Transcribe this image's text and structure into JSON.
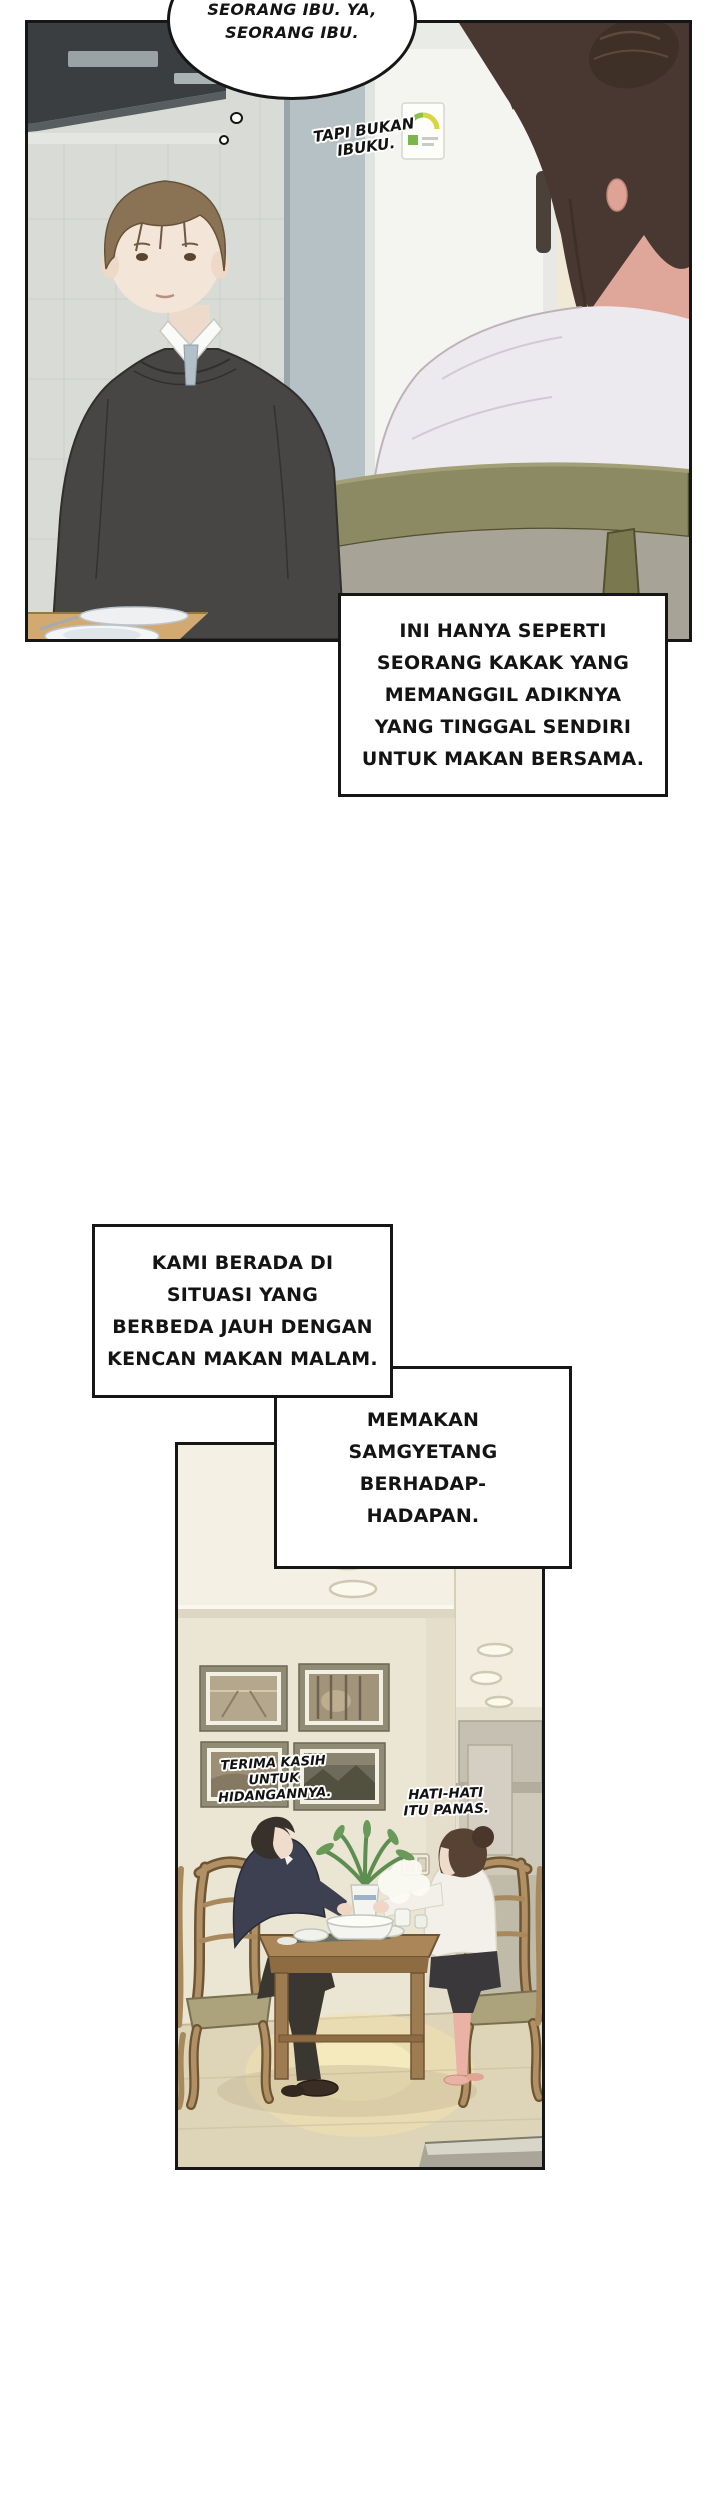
{
  "page": {
    "width": 720,
    "height": 2500,
    "background": "#ffffff"
  },
  "colors": {
    "panel_border": "#161616",
    "text": "#141414",
    "box_background": "#ffffff",
    "kitchen_wall_gray": "#d8dbd6",
    "fridge_white": "#f4f5f1",
    "energy_label_green": "#7ab648",
    "doorway_warm": "#f3ecd2",
    "man_sweater": "#474645",
    "man_hair_brown": "#8a7355",
    "woman_hair_dark": "#483831",
    "chair_olive": "#8b8a63",
    "dining_wall_cream": "#ebe5d3",
    "floor_beige": "#ded4b8",
    "floor_glow": "#f8ecc0",
    "table_wood": "#aa8659",
    "dining_chair_wood": "#b09064"
  },
  "top_panel": {
    "thought_bubble": {
      "lines": [
        "SEORANG IBU.",
        "YA, SEORANG IBU."
      ]
    },
    "floating_caption": {
      "lines": [
        "TAPI BUKAN",
        "IBUKU."
      ]
    }
  },
  "narration": {
    "box_ini": {
      "lines": [
        "INI HANYA SEPERTI",
        "SEORANG KAKAK YANG",
        "MEMANGGIL ADIKNYA",
        "YANG TINGGAL SENDIRI",
        "UNTUK MAKAN BERSAMA."
      ]
    },
    "box_kami": {
      "lines": [
        "KAMI BERADA DI",
        "SITUASI YANG",
        "BERBEDA JAUH DENGAN",
        "KENCAN MAKAN MALAM."
      ]
    },
    "box_memakan": {
      "lines": [
        "MEMAKAN",
        "SAMGYETANG",
        "BERHADAP-",
        "HADAPAN."
      ]
    }
  },
  "bottom_panel": {
    "speech_left": {
      "lines": [
        "TERIMA KASIH",
        "UNTUK",
        "HIDANGANNYA."
      ]
    },
    "speech_right": {
      "lines": [
        "HATI-HATI",
        "ITU PANAS."
      ]
    }
  }
}
